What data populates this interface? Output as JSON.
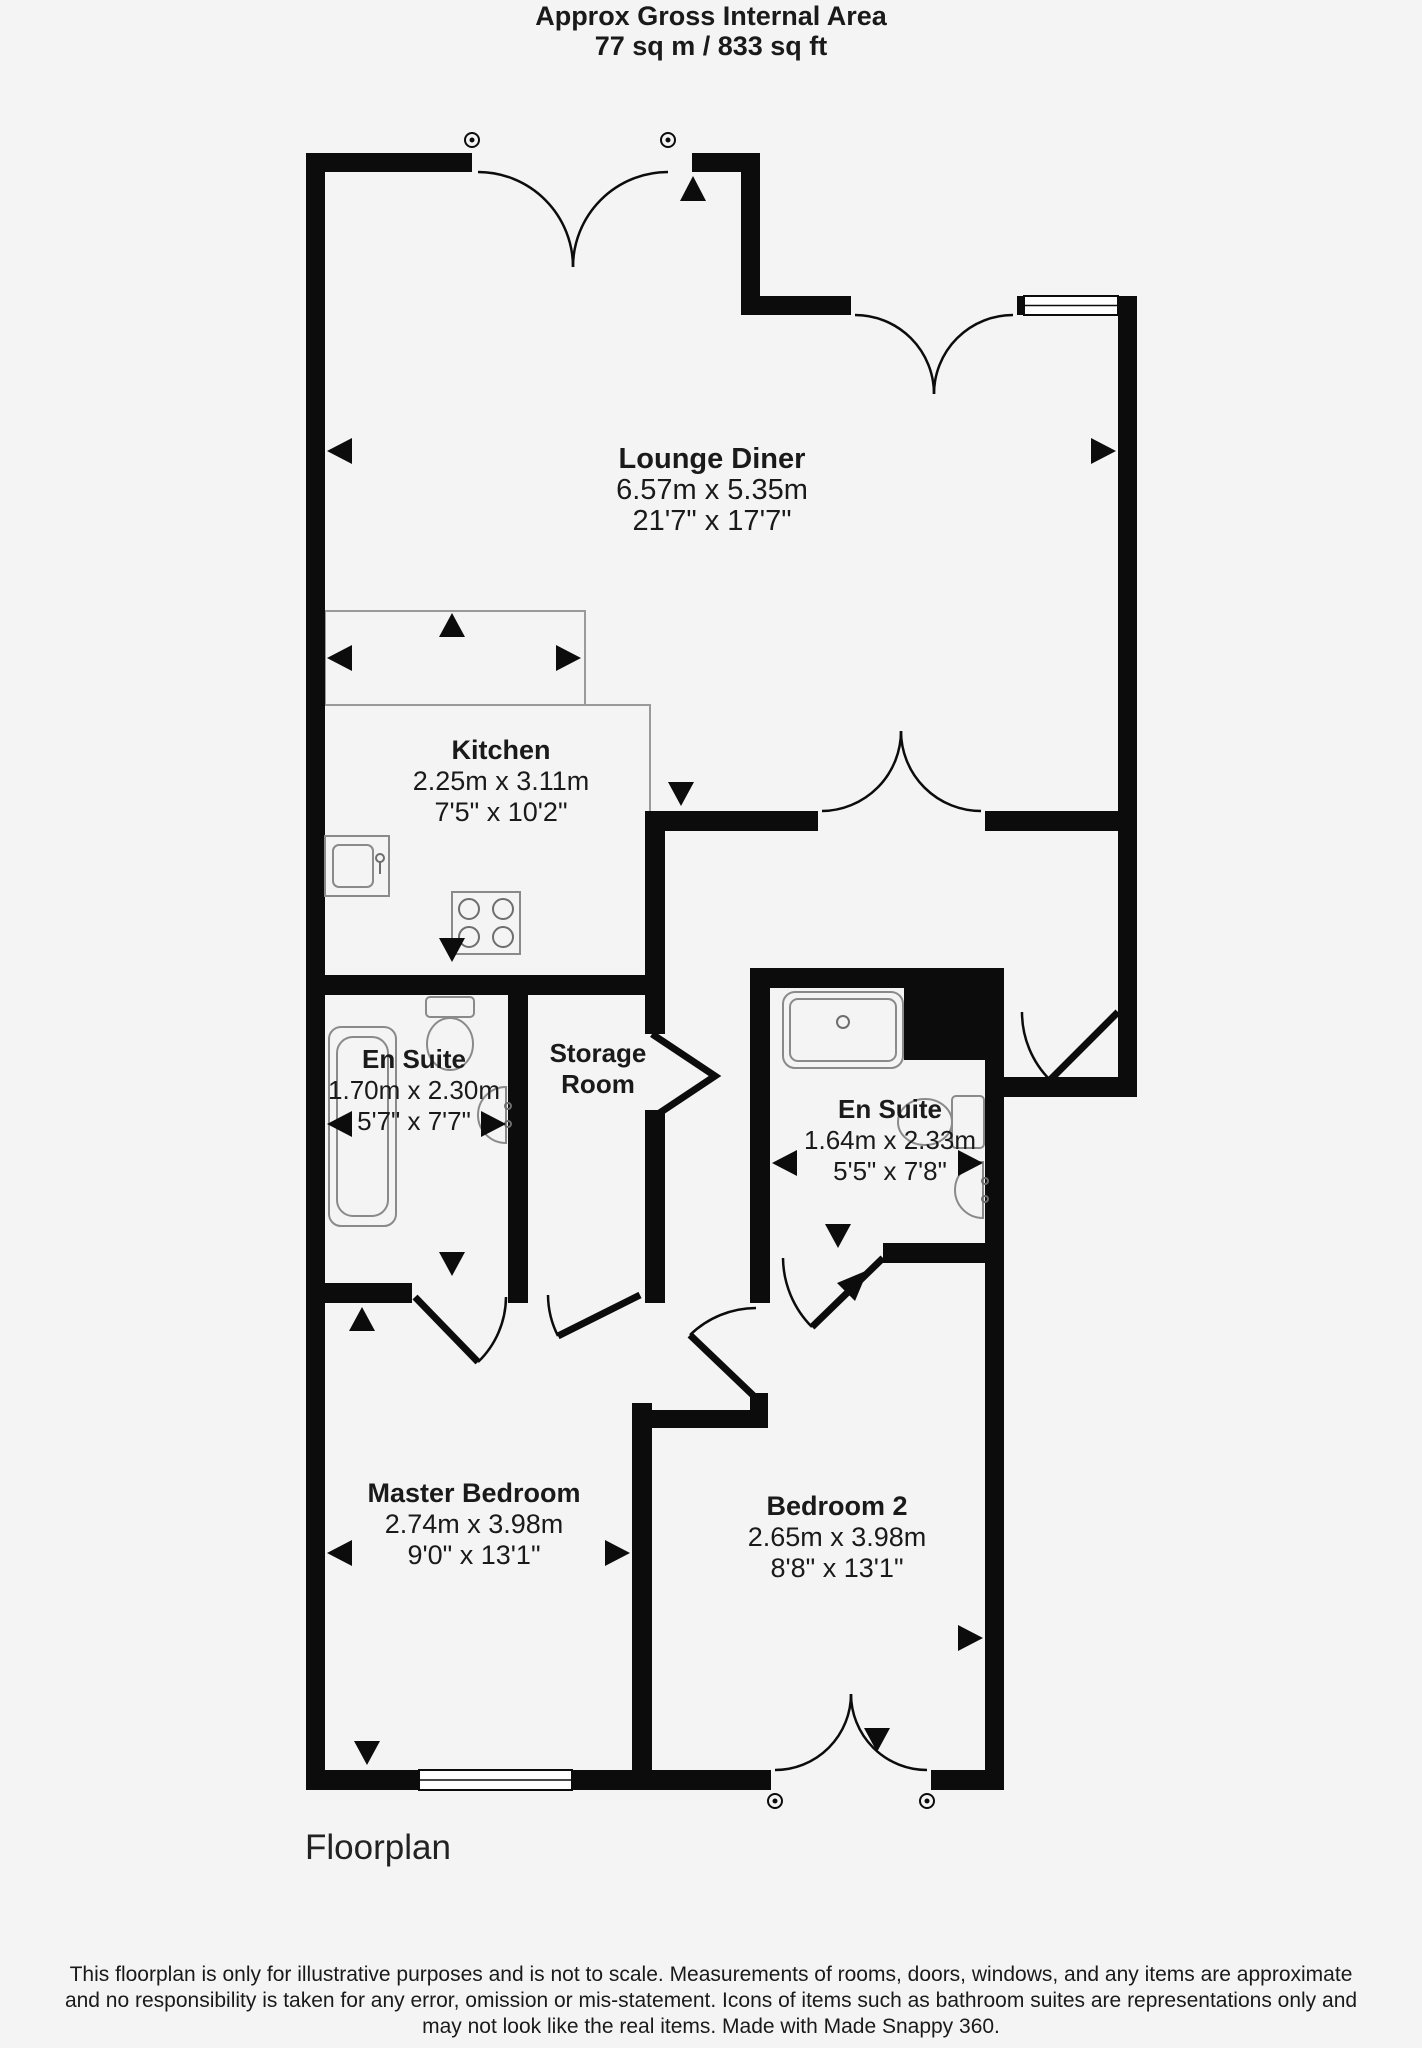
{
  "header": {
    "title": "Approx Gross Internal Area",
    "value": "77 sq m / 833 sq ft"
  },
  "rooms": [
    {
      "name": "Lounge Diner",
      "metric": "6.57m x 5.35m",
      "imperial": "21'7\" x 17'7\""
    },
    {
      "name": "Kitchen",
      "metric": "2.25m x 3.11m",
      "imperial": "7'5\" x 10'2\""
    },
    {
      "name": "En Suite",
      "metric": "1.70m x 2.30m",
      "imperial": "5'7\" x 7'7\""
    },
    {
      "name": "Storage Room"
    },
    {
      "name": "En Suite",
      "metric": "1.64m x 2.33m",
      "imperial": "5'5\" x 7'8\""
    },
    {
      "name": "Master Bedroom",
      "metric": "2.74m x 3.98m",
      "imperial": "9'0\" x 13'1\""
    },
    {
      "name": "Bedroom 2",
      "metric": "2.65m x 3.98m",
      "imperial": "8'8\" x 13'1\""
    }
  ],
  "caption": "Floorplan",
  "footer": {
    "line1": "This floorplan is only for illustrative purposes and is not to scale. Measurements of rooms, doors, windows, and any items are approximate",
    "line2": "and no responsibility is taken for any error, omission or mis-statement. Icons of items such as bathroom suites are representations only and",
    "line3": "may not look like the real items. Made with Made Snappy 360."
  },
  "colors": {
    "background": "#f4f4f5",
    "wall": "#0c0c0c",
    "fixture_outline": "#8a8a8a"
  }
}
